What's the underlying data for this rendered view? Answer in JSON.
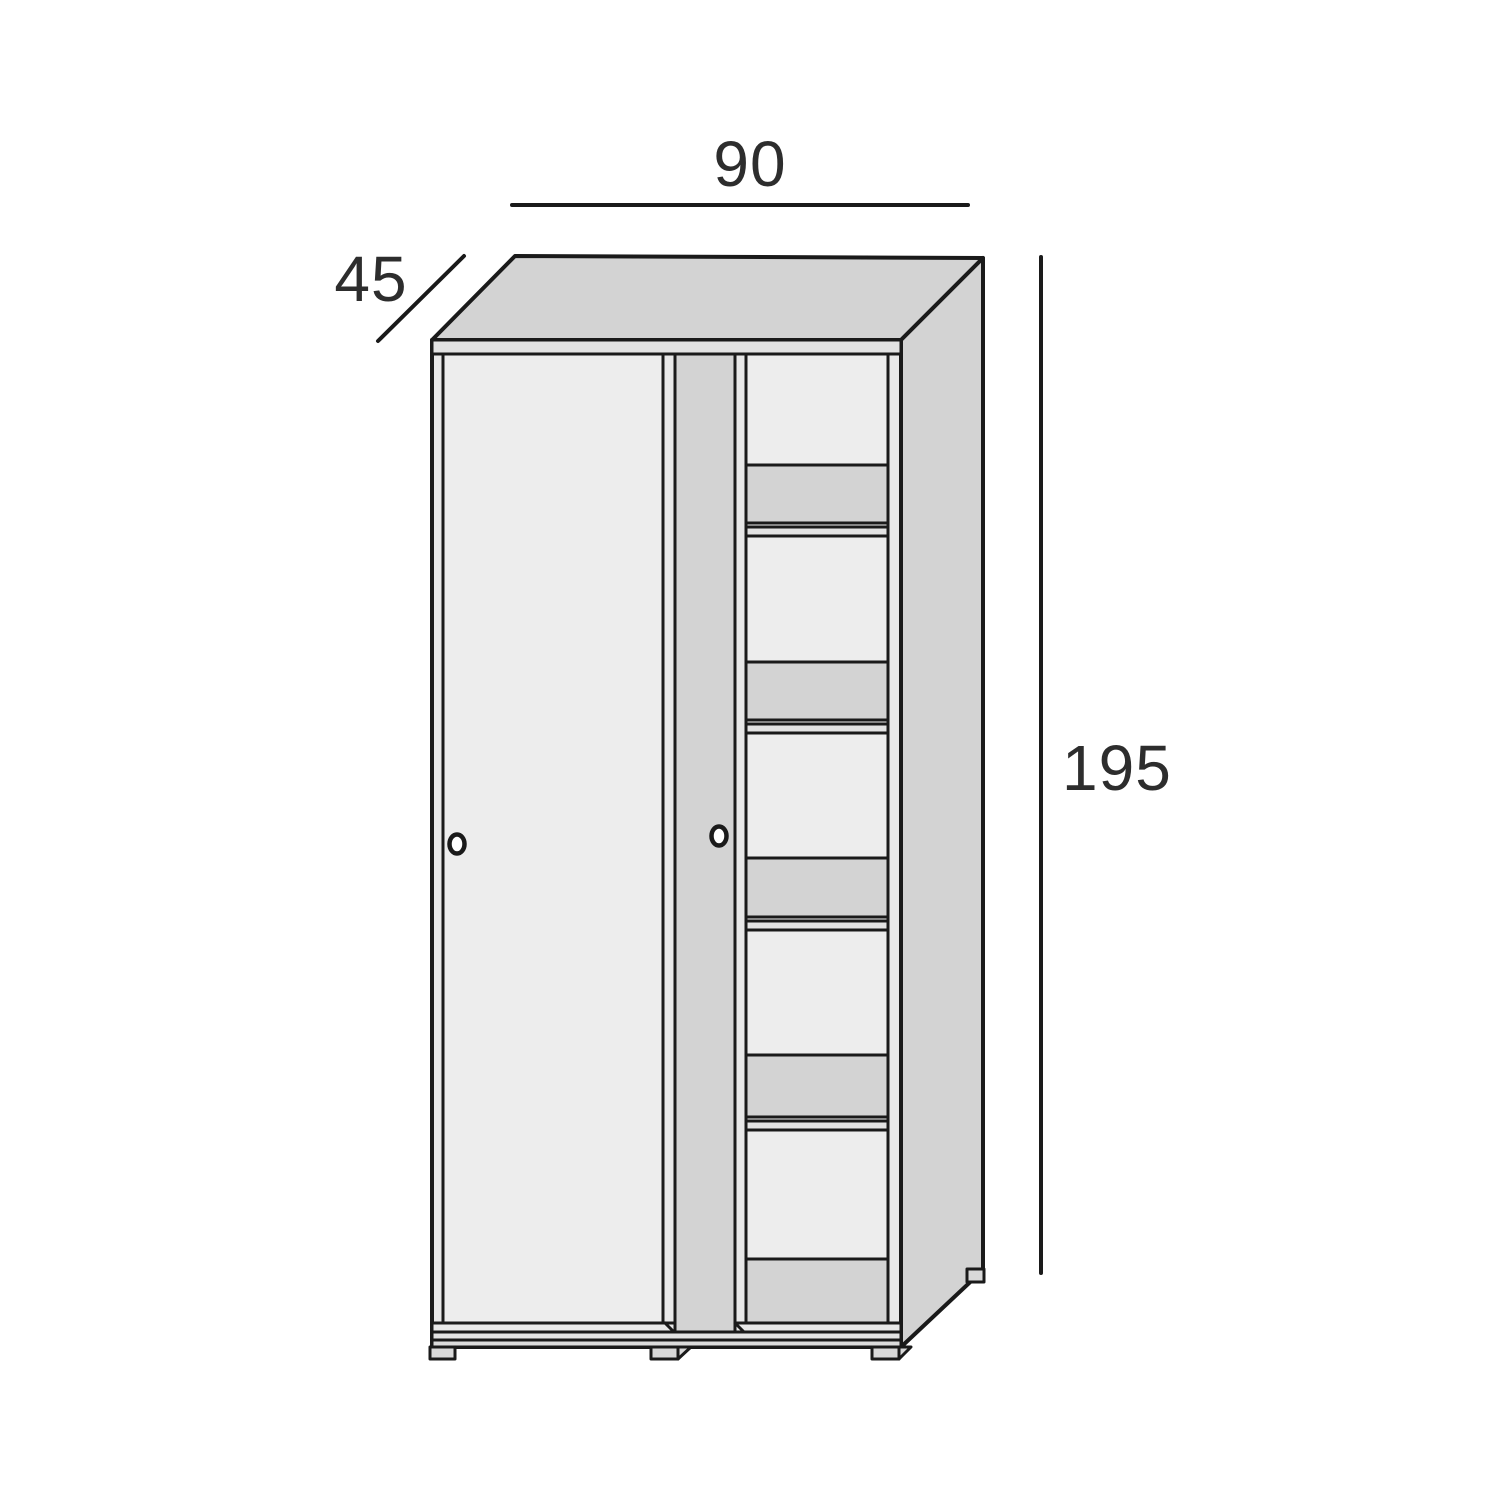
{
  "diagram": {
    "type": "furniture-dimension-drawing",
    "subject": "sliding-door wardrobe with interior shelves",
    "dimensions": {
      "width_label": "90",
      "depth_label": "45",
      "height_label": "195"
    },
    "structure": {
      "doors": 2,
      "handles": 2,
      "shelf_compartments": 6,
      "shelf_bands": 5,
      "feet_visible": 4
    }
  },
  "colors": {
    "background": "#ffffff",
    "outline": "#1a1a1a",
    "label_text": "#2d2d2d",
    "panel_light": "#ededed",
    "panel_base": "#e8e8e8",
    "panel_gray": "#d3d3d3",
    "rail_light": "#e3e3e3",
    "rail_mid": "#dcdcdc",
    "foot_gray": "#d9d9d9",
    "handle_fill": "#ffffff"
  }
}
